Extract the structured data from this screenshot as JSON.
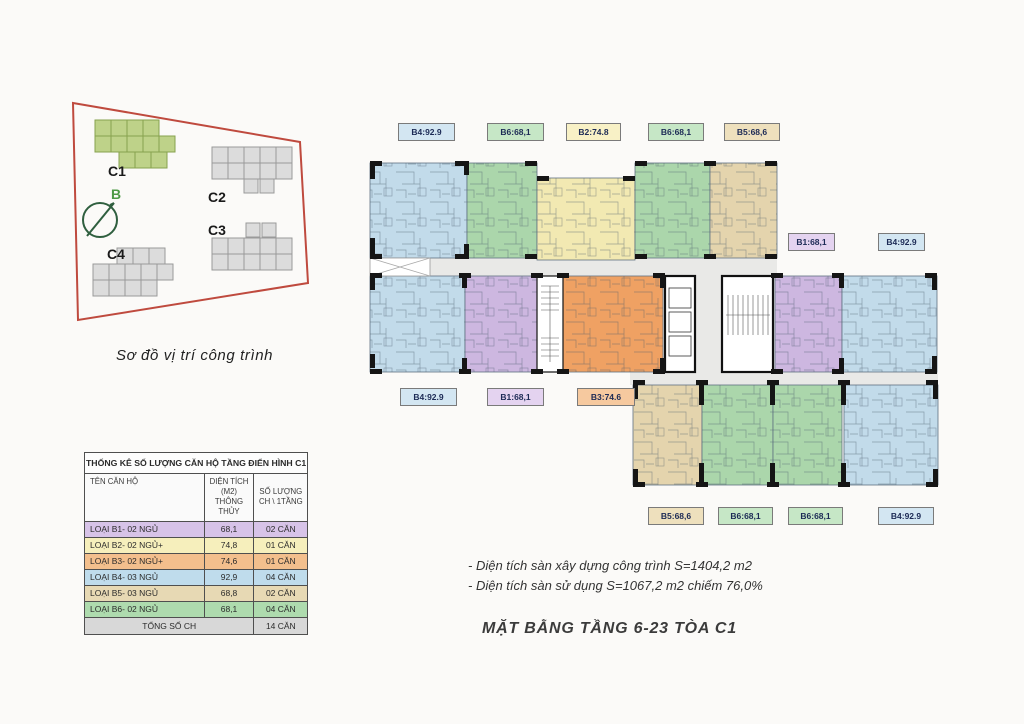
{
  "site_map": {
    "buildings": [
      {
        "id": "C1",
        "label": "C1",
        "highlighted": true
      },
      {
        "id": "C2",
        "label": "C2",
        "highlighted": false
      },
      {
        "id": "C3",
        "label": "C3",
        "highlighted": false
      },
      {
        "id": "C4",
        "label": "C4",
        "highlighted": false
      }
    ],
    "compass_label": "B",
    "caption": "Sơ đồ vị trí công trình"
  },
  "table": {
    "title": "THỐNG KÊ SỐ LƯỢNG CĂN HỘ TẦNG ĐIỂN HÌNH C1",
    "headers": {
      "name": "TÊN CĂN HỘ",
      "area_line1": "DIỆN TÍCH (M2)",
      "area_line2": "THÔNG THỦY",
      "qty_line1": "SỐ LƯỢNG",
      "qty_line2": "CH \\ 1TẦNG"
    },
    "rows": [
      {
        "name": "LOẠI B1- 02 NGỦ",
        "area": "68,1",
        "qty": "02 CĂN",
        "color": "#d7c3e8"
      },
      {
        "name": "LOẠI B2- 02 NGỦ+",
        "area": "74,8",
        "qty": "01 CĂN",
        "color": "#f6efbc"
      },
      {
        "name": "LOẠI B3- 02 NGỦ+",
        "area": "74,6",
        "qty": "01 CĂN",
        "color": "#f3bf8d"
      },
      {
        "name": "LOẠI B4- 03 NGỦ",
        "area": "92,9",
        "qty": "04 CĂN",
        "color": "#bfdcec"
      },
      {
        "name": "LOẠI B5- 03 NGỦ",
        "area": "68,8",
        "qty": "02 CĂN",
        "color": "#e7d9b4"
      },
      {
        "name": "LOẠI B6- 02 NGỦ",
        "area": "68,1",
        "qty": "04 CĂN",
        "color": "#aedbae"
      }
    ],
    "total": {
      "label": "TỔNG SỐ CH",
      "qty": "14 CĂN"
    }
  },
  "floorplan": {
    "unit_colors": {
      "B1": "#cdb7e0",
      "B2": "#f2e9b2",
      "B3": "#efa163",
      "B4": "#c2dbea",
      "B5": "#e4d4ad",
      "B6": "#abd6ab"
    },
    "labels": [
      {
        "text": "B4:92.9",
        "type": "B4"
      },
      {
        "text": "B6:68,1",
        "type": "B6"
      },
      {
        "text": "B2:74.8",
        "type": "B2"
      },
      {
        "text": "B6:68,1",
        "type": "B6"
      },
      {
        "text": "B5:68,6",
        "type": "B5"
      },
      {
        "text": "B1:68,1",
        "type": "B1"
      },
      {
        "text": "B4:92.9",
        "type": "B4"
      },
      {
        "text": "B4:92.9",
        "type": "B4"
      },
      {
        "text": "B1:68,1",
        "type": "B1"
      },
      {
        "text": "B3:74.6",
        "type": "B3"
      },
      {
        "text": "B5:68,6",
        "type": "B5"
      },
      {
        "text": "B6:68,1",
        "type": "B6"
      },
      {
        "text": "B6:68,1",
        "type": "B6"
      },
      {
        "text": "B4:92.9",
        "type": "B4"
      }
    ]
  },
  "notes": {
    "line1": "- Diện tích sàn xây dựng công trình S=1404,2 m2",
    "line2": "- Diện tích sàn sử dụng S=1067,2 m2 chiếm 76,0%"
  },
  "main_title": "MẶT BẰNG TẦNG 6-23 TÒA C1",
  "colors": {
    "site_outline_red": "#bf4a3e",
    "highlight_green_fill": "#bed289",
    "highlight_green_stroke": "#87a24e",
    "gray_building_fill": "#dcdcdc",
    "compass_green": "#2f5f3f",
    "label_text_navy": "#1c2a55"
  }
}
